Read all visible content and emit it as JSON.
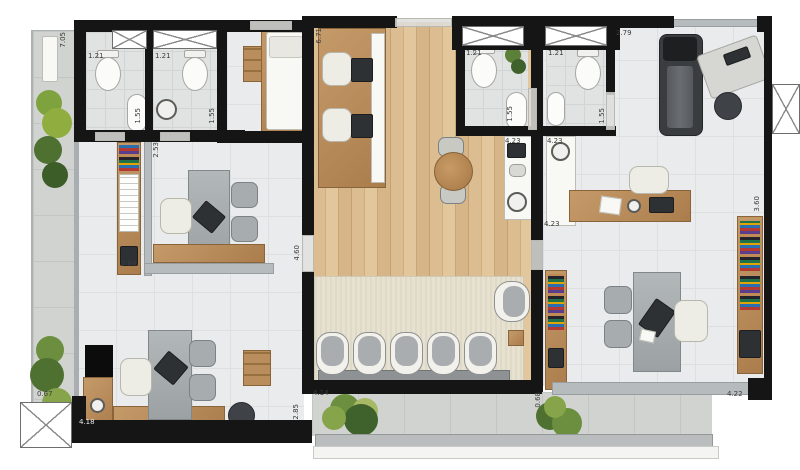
{
  "plan_type": "apartment-office floor plan (top view render)",
  "colors": {
    "wall": "#151515",
    "wood_floor": "#d8b88c",
    "tile_floor": "#eaebec",
    "concrete_terrace": "#d0d3d0",
    "rug": "#e7e1d0",
    "furniture_wood": "#b98c5b",
    "plant_green": "#5d8038",
    "glass_partition": "#b6bbbd"
  },
  "labels": {
    "corridor_h": "7.05",
    "bath1_w": "1.21",
    "bath2_w": "1.21",
    "bath1_d": "1.55",
    "bath2_d": "1.55",
    "shelf_wall": "2.53",
    "studio_h": "6.71",
    "bath3_w": "1.21",
    "bath3_d": "1.55",
    "bath4_w": "1.21",
    "bath4_d": "1.55",
    "gym_top_w": "2.79",
    "kitchen1_l": "4.23",
    "kitchen2_l_top": "4.23",
    "kitchen2_l_bottom": "4.23",
    "office3_d": "3.60",
    "office1_w": "2.88",
    "office1_d": "4.60",
    "terrace_left_w": "0.67",
    "office2_w": "4.18",
    "lounge_w": "4.14",
    "lounge_d": "2.85",
    "terrace_right_w": "0.68",
    "office3_w": "4.22"
  }
}
